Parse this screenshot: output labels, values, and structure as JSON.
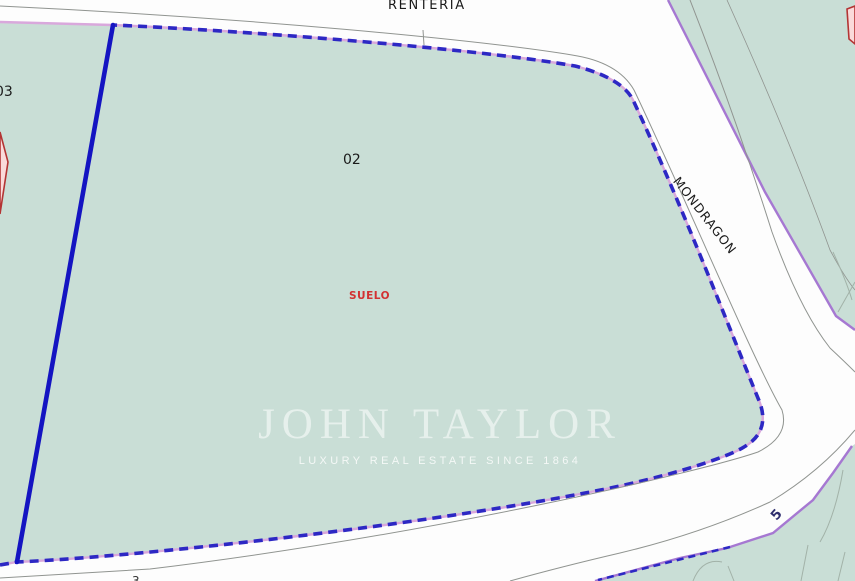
{
  "map": {
    "labels": {
      "street_top": "RENTERIA",
      "street_right": "MONDRAGON",
      "parcel_number": "02",
      "adjacent_parcel_number": "03",
      "land_use": "SUELO",
      "road_number": "5",
      "road_number_bottom": "3"
    },
    "watermark": {
      "title": "JOHN TAYLOR",
      "subtitle": "LUXURY REAL ESTATE SINCE 1864"
    },
    "colors": {
      "parcel-fill": "#c9ded6",
      "road-fill": "#fdfdfd",
      "boundary-dash": "#2d28c4",
      "boundary-solid": "#1414c2",
      "boundary-under": "#d9a8dc",
      "neighbor-edge": "#a678d2",
      "road-line": "#909490",
      "veg-line": "#a2b2a8",
      "label-dark": "#1a1a1a",
      "label-red": "#d23232",
      "red-overlay-stroke": "#b43434",
      "red-overlay-fill": "#fadada",
      "watermark": "#ffffff"
    }
  }
}
